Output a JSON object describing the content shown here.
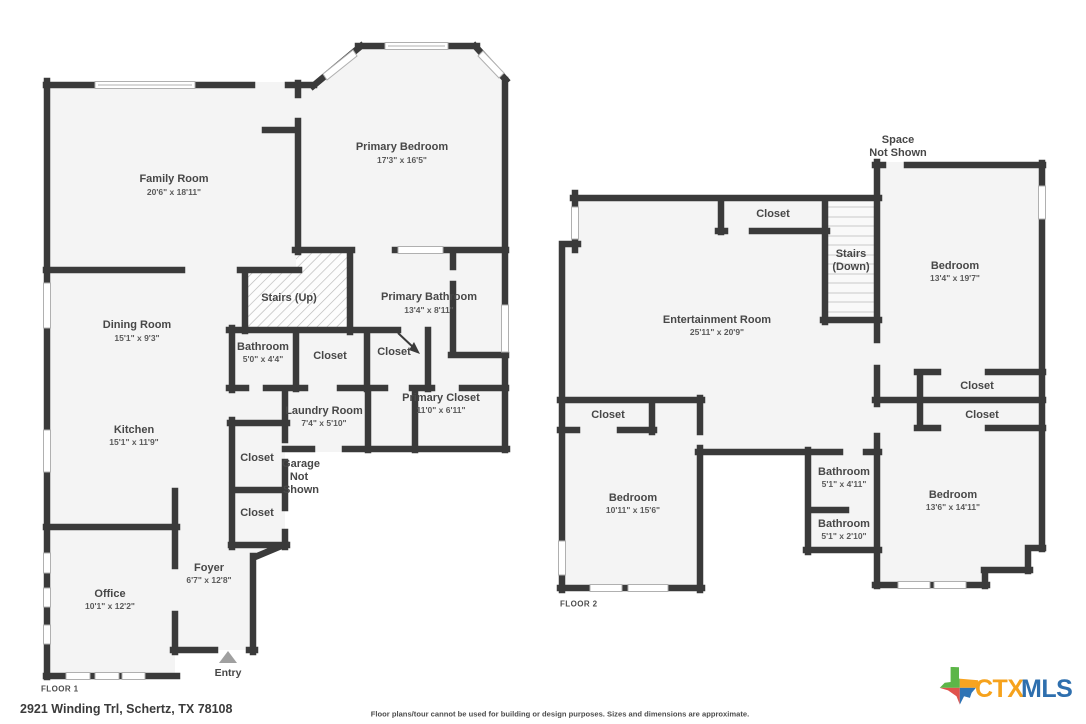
{
  "colors": {
    "wall": "#3a3a3a",
    "room_fill": "#f4f4f4",
    "label": "#474747",
    "logo_ctx_orange": "#F6A21C",
    "logo_mls_blue": "#2E6FAE",
    "texas_green": "#5CB648",
    "texas_orange": "#F7A421",
    "texas_red": "#E0524C",
    "texas_blue": "#2F74B5"
  },
  "floor1": {
    "label": "FLOOR 1",
    "stairs_label": "Stairs (Up)",
    "entry_label": "Entry",
    "garage_note": {
      "line1": "Garage",
      "line2": "Not",
      "line3": "Shown"
    },
    "rooms": [
      {
        "name": "Family Room",
        "dims": "20'6\" x 18'11\""
      },
      {
        "name": "Primary Bedroom",
        "dims": "17'3\" x 16'5\""
      },
      {
        "name": "Dining Room",
        "dims": "15'1\" x 9'3\""
      },
      {
        "name": "Primary Bathroom",
        "dims": "13'4\" x 8'11\""
      },
      {
        "name": "Bathroom",
        "dims": "5'0\" x 4'4\""
      },
      {
        "name": "Closet"
      },
      {
        "name": "Closet"
      },
      {
        "name": "Primary Closet",
        "dims": "11'0\" x 6'11\""
      },
      {
        "name": "Laundry Room",
        "dims": "7'4\" x 5'10\""
      },
      {
        "name": "Kitchen",
        "dims": "15'1\" x 11'9\""
      },
      {
        "name": "Closet"
      },
      {
        "name": "Closet"
      },
      {
        "name": "Foyer",
        "dims": "6'7\" x 12'8\""
      },
      {
        "name": "Office",
        "dims": "10'1\" x 12'2\""
      }
    ]
  },
  "floor2": {
    "label": "FLOOR 2",
    "stairs_label": {
      "line1": "Stairs",
      "line2": "(Down)"
    },
    "space_note": {
      "line1": "Space",
      "line2": "Not Shown"
    },
    "rooms": [
      {
        "name": "Entertainment Room",
        "dims": "25'11\" x 20'9\""
      },
      {
        "name": "Bedroom",
        "dims": "13'4\" x 19'7\""
      },
      {
        "name": "Bedroom",
        "dims": "10'11\" x 15'6\""
      },
      {
        "name": "Bedroom",
        "dims": "13'6\" x 14'11\""
      },
      {
        "name": "Bathroom",
        "dims": "5'1\" x 4'11\""
      },
      {
        "name": "Bathroom",
        "dims": "5'1\" x 2'10\""
      },
      {
        "name": "Closet"
      },
      {
        "name": "Closet"
      },
      {
        "name": "Closet"
      },
      {
        "name": "Closet"
      }
    ]
  },
  "footer": {
    "address": "2921 Winding Trl, Schertz, TX 78108",
    "disclaimer": "Floor plans/tour cannot be used for building or design purposes. Sizes and dimensions are approximate."
  },
  "logo": {
    "ctx": "CTX",
    "mls": "MLS"
  }
}
